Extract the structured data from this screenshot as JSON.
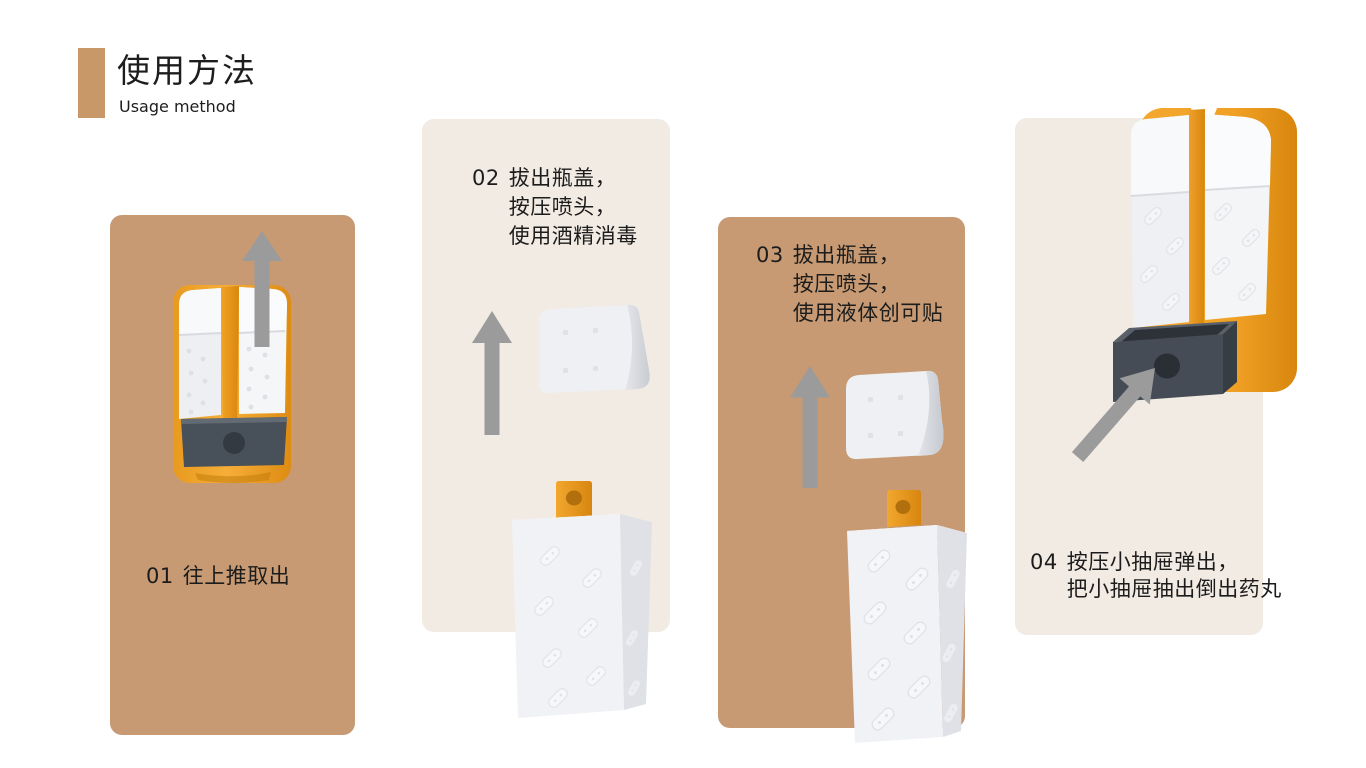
{
  "title": {
    "zh": "使用方法",
    "en": "Usage method"
  },
  "colors": {
    "accent": "#c89868",
    "panel_tan": "#c79a73",
    "panel_cream": "#f2ebe3",
    "product_orange": "#f0a125",
    "drawer_gray": "#454c55",
    "arrow_gray": "#9b9b9b",
    "text": "#1c1c1c",
    "background": "#ffffff"
  },
  "icons": {
    "up_arrow": "up-arrow",
    "diagonal_up_right_arrow": "diagonal-up-right-arrow"
  },
  "steps": [
    {
      "number": "01",
      "lines": [
        "往上推取出"
      ]
    },
    {
      "number": "02",
      "lines": [
        "拔出瓶盖，",
        "按压喷头，",
        "使用酒精消毒"
      ]
    },
    {
      "number": "03",
      "lines": [
        "拔出瓶盖，",
        "按压喷头，",
        "使用液体创可贴"
      ]
    },
    {
      "number": "04",
      "lines": [
        "按压小抽屉弹出，",
        "把小抽屉抽出倒出药丸"
      ]
    }
  ]
}
